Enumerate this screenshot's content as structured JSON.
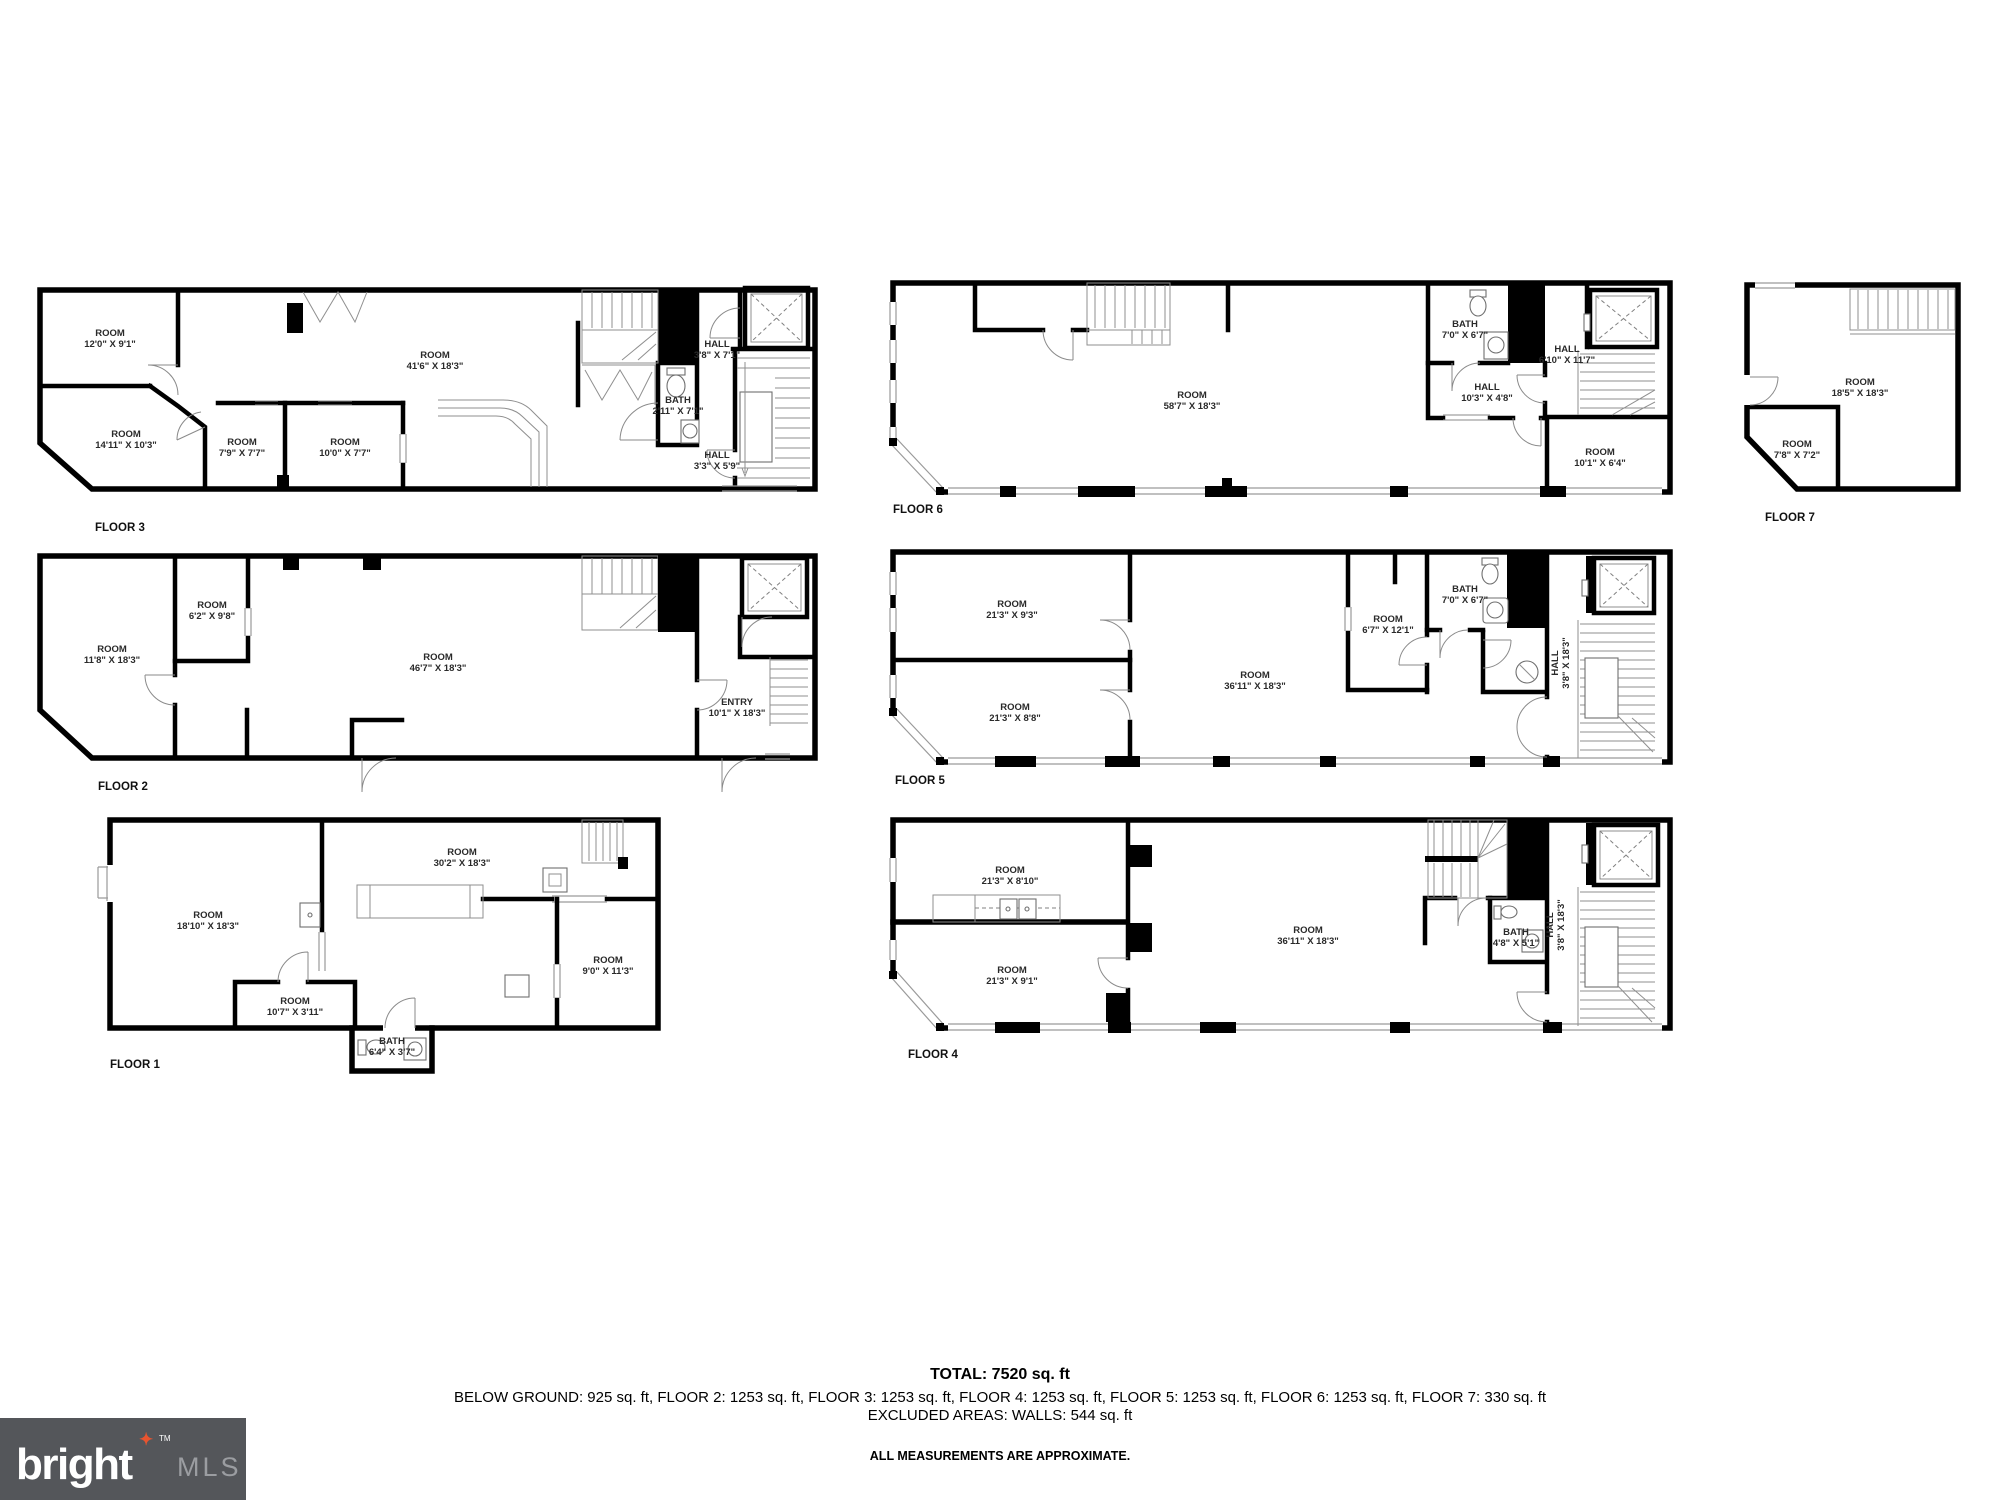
{
  "floors": [
    {
      "id": "floor-3",
      "label": "FLOOR 3",
      "rooms": [
        {
          "type": "ROOM",
          "dims": "12'0\" X 9'1\""
        },
        {
          "type": "ROOM",
          "dims": "14'11\" X 10'3\""
        },
        {
          "type": "ROOM",
          "dims": "7'9\" X 7'7\""
        },
        {
          "type": "ROOM",
          "dims": "10'0\" X 7'7\""
        },
        {
          "type": "ROOM",
          "dims": "41'6\" X 18'3\""
        },
        {
          "type": "HALL",
          "dims": "3'8\" X 7'1\""
        },
        {
          "type": "BATH",
          "dims": "2'11\" X 7'1\""
        },
        {
          "type": "HALL",
          "dims": "3'3\" X 5'9\""
        }
      ]
    },
    {
      "id": "floor-6",
      "label": "FLOOR 6",
      "rooms": [
        {
          "type": "ROOM",
          "dims": "58'7\" X 18'3\""
        },
        {
          "type": "BATH",
          "dims": "7'0\" X 6'7\""
        },
        {
          "type": "HALL",
          "dims": "10'3\" X 4'8\""
        },
        {
          "type": "HALL",
          "dims": "6'10\" X 11'7\""
        },
        {
          "type": "ROOM",
          "dims": "10'1\" X 6'4\""
        }
      ]
    },
    {
      "id": "floor-7",
      "label": "FLOOR 7",
      "rooms": [
        {
          "type": "ROOM",
          "dims": "18'5\" X 18'3\""
        },
        {
          "type": "ROOM",
          "dims": "7'8\" X 7'2\""
        }
      ]
    },
    {
      "id": "floor-2",
      "label": "FLOOR 2",
      "rooms": [
        {
          "type": "ROOM",
          "dims": "11'8\" X 18'3\""
        },
        {
          "type": "ROOM",
          "dims": "6'2\" X 9'8\""
        },
        {
          "type": "ROOM",
          "dims": "46'7\" X 18'3\""
        },
        {
          "type": "ENTRY",
          "dims": "10'1\" X 18'3\""
        }
      ]
    },
    {
      "id": "floor-5",
      "label": "FLOOR 5",
      "rooms": [
        {
          "type": "ROOM",
          "dims": "21'3\" X 9'3\""
        },
        {
          "type": "ROOM",
          "dims": "21'3\" X 8'8\""
        },
        {
          "type": "ROOM",
          "dims": "36'11\" X 18'3\""
        },
        {
          "type": "ROOM",
          "dims": "6'7\" X 12'1\""
        },
        {
          "type": "BATH",
          "dims": "7'0\" X 6'7\""
        },
        {
          "type": "HALL",
          "dims": "3'8\" X 18'3\""
        }
      ]
    },
    {
      "id": "floor-1",
      "label": "FLOOR 1",
      "rooms": [
        {
          "type": "ROOM",
          "dims": "18'10\" X 18'3\""
        },
        {
          "type": "ROOM",
          "dims": "30'2\" X 18'3\""
        },
        {
          "type": "ROOM",
          "dims": "10'7\" X 3'11\""
        },
        {
          "type": "BATH",
          "dims": "6'4\" X 3'7\""
        },
        {
          "type": "ROOM",
          "dims": "9'0\" X 11'3\""
        }
      ]
    },
    {
      "id": "floor-4",
      "label": "FLOOR 4",
      "rooms": [
        {
          "type": "ROOM",
          "dims": "21'3\" X 8'10\""
        },
        {
          "type": "ROOM",
          "dims": "21'3\" X 9'1\""
        },
        {
          "type": "ROOM",
          "dims": "36'11\" X 18'3\""
        },
        {
          "type": "BATH",
          "dims": "4'8\" X 5'1\""
        },
        {
          "type": "HALL",
          "dims": "3'8\" X 18'3\""
        }
      ]
    }
  ],
  "summary": {
    "total": "TOTAL: 7520 sq. ft",
    "breakdown": "BELOW GROUND: 925 sq. ft, FLOOR 2: 1253 sq. ft, FLOOR 3: 1253 sq. ft, FLOOR 4: 1253 sq. ft, FLOOR 5: 1253 sq. ft, FLOOR 6: 1253 sq. ft, FLOOR 7: 330 sq. ft",
    "excluded": "EXCLUDED AREAS: WALLS: 544 sq. ft",
    "disclaimer": "ALL MEASUREMENTS ARE APPROXIMATE."
  },
  "logo": {
    "brand": "bright",
    "tm": "TM",
    "suffix": "MLS",
    "star": "✦",
    "bg_color": "#54565A",
    "star_color": "#E8542F",
    "suffix_color": "#9B9DA1"
  }
}
